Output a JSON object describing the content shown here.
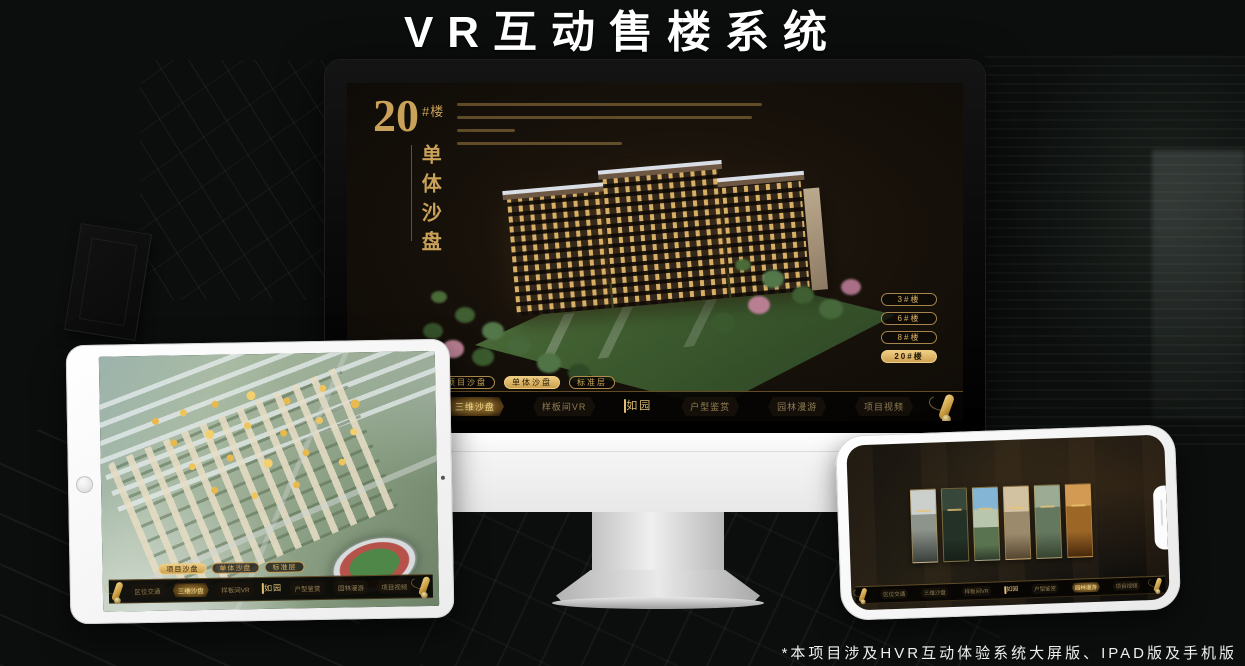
{
  "page": {
    "title": "VR互动售楼系统",
    "footnote": "*本项目涉及HVR互动体验系统大屏版、IPAD版及手机版"
  },
  "colors": {
    "gold": "#c9a159",
    "gold_bright": "#eecd82",
    "screen_bg": "#17110a",
    "canvas_bg": "#0b0e0c"
  },
  "nav": {
    "logo": "如园",
    "tabs": [
      {
        "label": "项目沙盘"
      },
      {
        "label": "单体沙盘"
      },
      {
        "label": "标准层"
      }
    ],
    "items": [
      {
        "label": "区位交通"
      },
      {
        "label": "三维沙盘"
      },
      {
        "label": "样板间VR"
      },
      {
        "label": "户型鉴赏"
      },
      {
        "label": "园林漫游"
      },
      {
        "label": "项目视频"
      }
    ]
  },
  "monitor": {
    "unit_number": "20",
    "unit_suffix": "#楼",
    "unit_caption": "单体沙盘",
    "active_tab": "单体沙盘",
    "active_nav_item": "三维沙盘",
    "floor_buttons": [
      {
        "label": "3#楼",
        "active": false
      },
      {
        "label": "6#楼",
        "active": false
      },
      {
        "label": "8#楼",
        "active": false
      },
      {
        "label": "20#楼",
        "active": true
      }
    ]
  },
  "tablet": {
    "active_tab": "项目沙盘",
    "active_nav_item": "三维沙盘"
  },
  "phone": {
    "active_nav_item": "园林漫游"
  }
}
